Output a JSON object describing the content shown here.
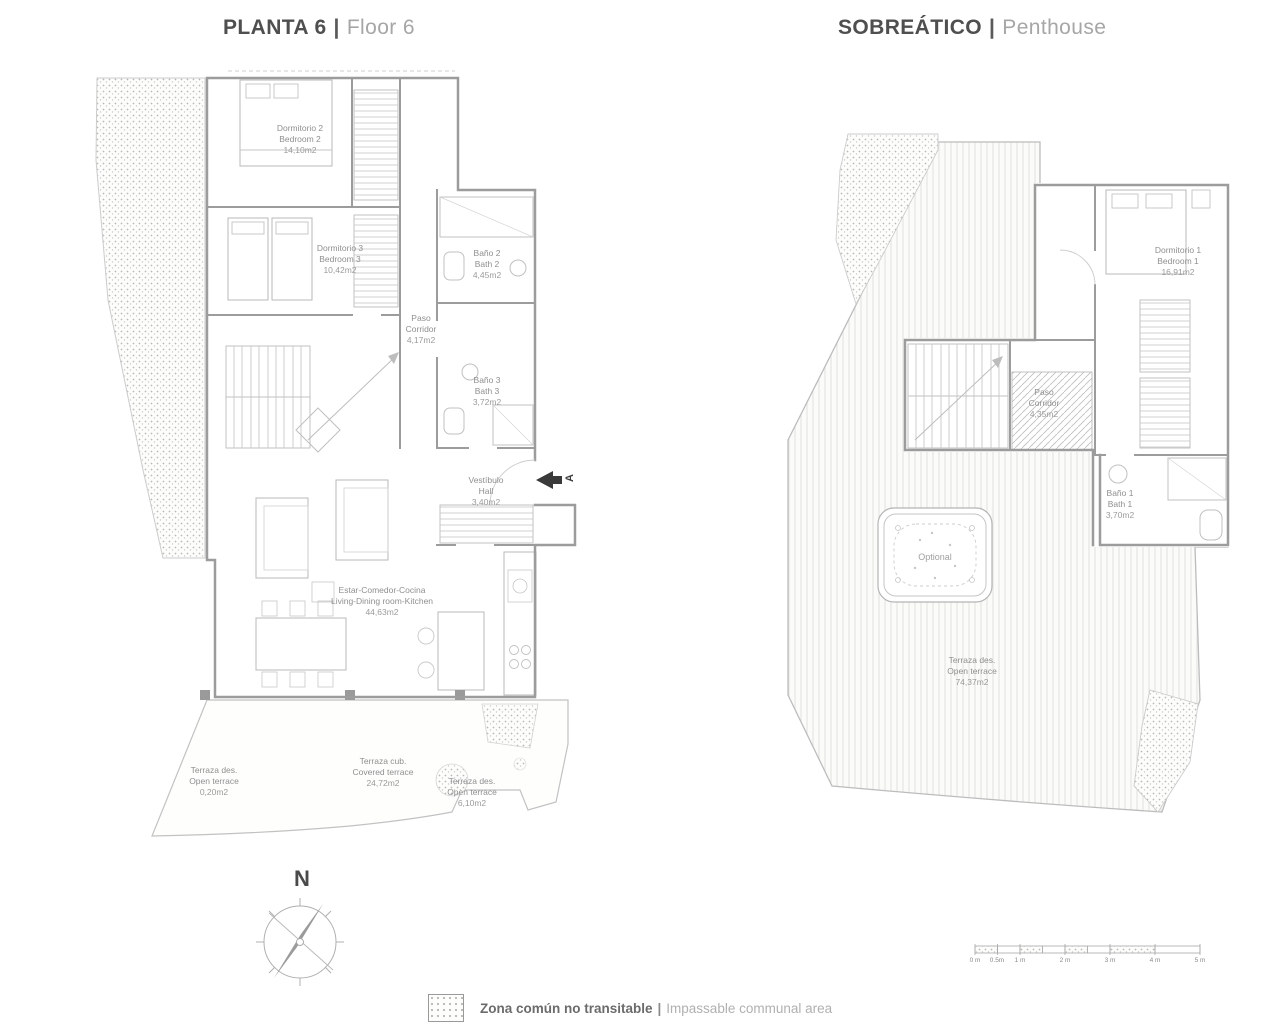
{
  "plan6": {
    "title_es": "PLANTA 6",
    "title_sep": "|",
    "title_en": "Floor 6",
    "rooms": {
      "bedroom2": {
        "es": "Dormitorio 2",
        "en": "Bedroom 2",
        "area": "14,10m2"
      },
      "bedroom3": {
        "es": "Dormitorio 3",
        "en": "Bedroom 3",
        "area": "10,42m2"
      },
      "bath2": {
        "es": "Baño 2",
        "en": "Bath 2",
        "area": "4,45m2"
      },
      "corridor": {
        "es": "Paso",
        "en": "Corridor",
        "area": "4,17m2"
      },
      "bath3": {
        "es": "Baño 3",
        "en": "Bath 3",
        "area": "3,72m2"
      },
      "hall": {
        "es": "Vestíbulo",
        "en": "Hall",
        "area": "3,40m2"
      },
      "living": {
        "es": "Estar-Comedor-Cocina",
        "en": "Living-Dining room-Kitchen",
        "area": "44,63m2"
      },
      "terrace_open_left": {
        "es": "Terraza des.",
        "en": "Open terrace",
        "area": "0,20m2"
      },
      "terrace_covered": {
        "es": "Terraza cub.",
        "en": "Covered terrace",
        "area": "24,72m2"
      },
      "terrace_open_right": {
        "es": "Terraza des.",
        "en": "Open terrace",
        "area": "6,10m2"
      }
    },
    "entrance_marker": "A"
  },
  "penthouse": {
    "title_es": "SOBREÁTICO",
    "title_sep": "|",
    "title_en": "Penthouse",
    "rooms": {
      "bedroom1": {
        "es": "Dormitorio 1",
        "en": "Bedroom 1",
        "area": "16,91m2"
      },
      "corridor": {
        "es": "Paso",
        "en": "Corridor",
        "area": "4,35m2"
      },
      "bath1": {
        "es": "Baño 1",
        "en": "Bath 1",
        "area": "3,70m2"
      },
      "terrace": {
        "es": "Terraza des.",
        "en": "Open terrace",
        "area": "74,37m2"
      }
    },
    "hot_tub_label": "Optional"
  },
  "compass": {
    "north_label": "N"
  },
  "scalebar": {
    "labels": [
      "0 m",
      "0.5m",
      "1 m",
      "2 m",
      "3 m",
      "4 m",
      "5 m"
    ]
  },
  "legend": {
    "label_es": "Zona común no transitable",
    "sep": "|",
    "label_en": "Impassable communal area"
  },
  "colors": {
    "wall": "#9c9c9c",
    "thin_line": "#c2c2c2",
    "label_text": "#8f8f8f",
    "title_dark": "#4f4f4f",
    "title_light": "#a6a6a6",
    "stipple_dot": "#b9b9b9"
  }
}
